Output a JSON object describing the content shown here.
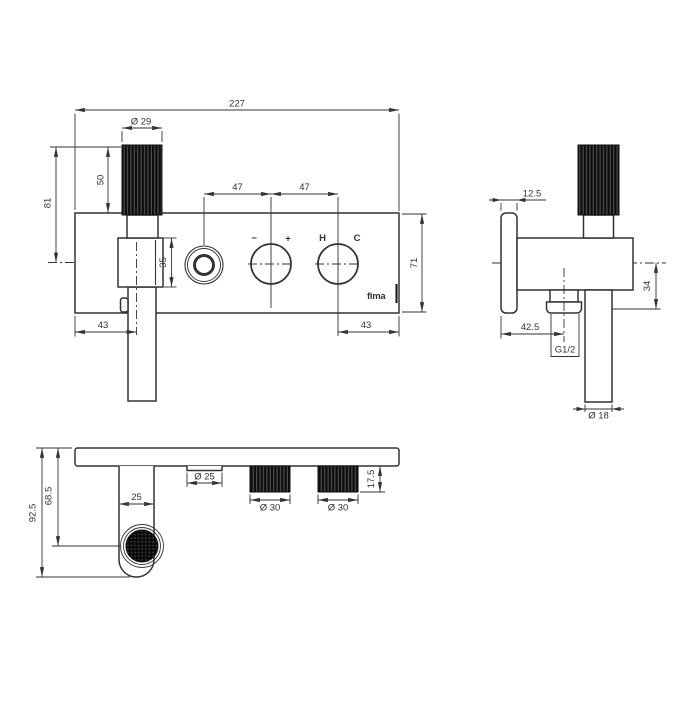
{
  "page": {
    "background": "#ffffff",
    "line_color": "#333333",
    "part_fill": "#0d0d0d"
  },
  "front_view": {
    "dims": {
      "overall_width": "227",
      "knob_diameter": "Ø 29",
      "knob_height": "50",
      "knob_top_to_spout_axis": "81",
      "diverter_to_mixer_spacing": "47",
      "mixer_to_temp_spacing": "47",
      "spout_body_height": "35",
      "spout_axis_offset": "43",
      "temp_control_offset": "43",
      "plate_height": "71"
    },
    "labels": {
      "minus": "−",
      "plus": "+",
      "hot": "H",
      "cold": "C"
    },
    "logo": "fima"
  },
  "side_view": {
    "dims": {
      "plate_thickness": "12.5",
      "axis_to_outlet": "34",
      "plate_to_outlet_center": "42.5",
      "outlet_thread": "G1/2",
      "pipe_diameter": "Ø 18"
    }
  },
  "bottom_view": {
    "dims": {
      "overall_depth": "92.5",
      "aerator_center_depth": "68.5",
      "spout_width": "25",
      "diverter_diameter": "Ø 25",
      "mixer_knob_diameter": "Ø 30",
      "temp_knob_diameter": "Ø 30",
      "knob_height": "17.5"
    }
  }
}
